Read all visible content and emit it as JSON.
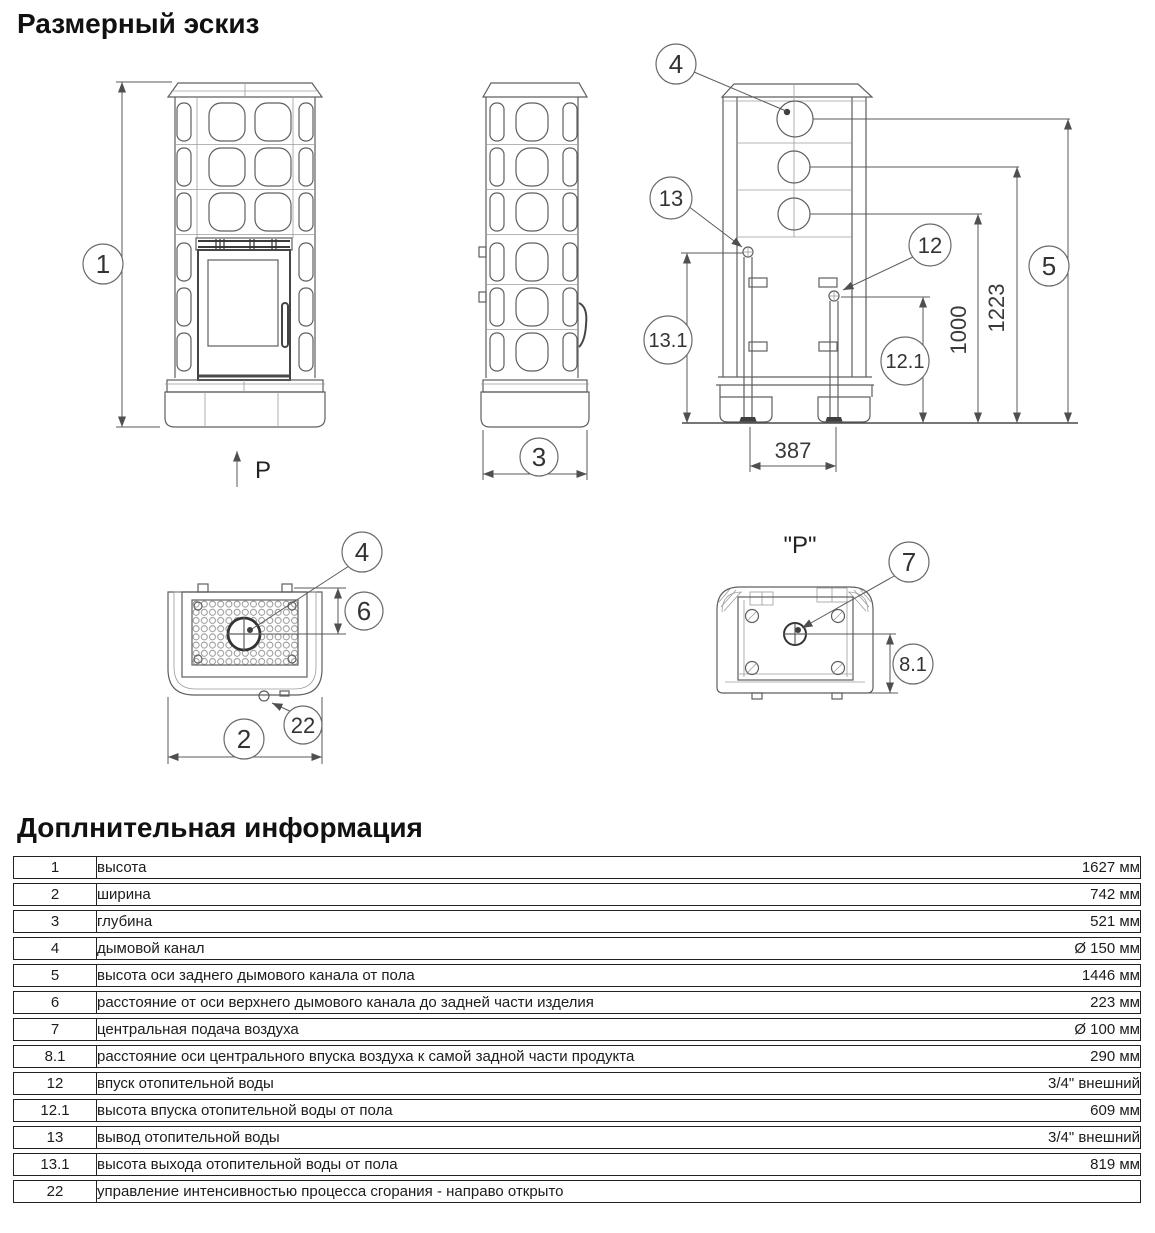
{
  "page": {
    "title": "Размерный эскиз",
    "info_title": "Доплнительная информация"
  },
  "drawing": {
    "balloons": {
      "b1": "1",
      "b2": "2",
      "b3": "3",
      "b4": "4",
      "b5": "5",
      "b6": "6",
      "b7": "7",
      "b8_1": "8.1",
      "b12": "12",
      "b12_1": "12.1",
      "b13": "13",
      "b13_1": "13.1",
      "b22": "22"
    },
    "dims": {
      "h1223": "1223",
      "h1000": "1000",
      "w387": "387"
    },
    "labels": {
      "p_arrow": "P",
      "p_view": "\"P\""
    }
  },
  "table": {
    "rows": [
      {
        "num": "1",
        "desc": "высота",
        "value": "1627 мм"
      },
      {
        "num": "2",
        "desc": "ширина",
        "value": "742 мм"
      },
      {
        "num": "3",
        "desc": "глубина",
        "value": "521 мм"
      },
      {
        "num": "4",
        "desc": "дымовой канал",
        "value": "Ø 150 мм"
      },
      {
        "num": "5",
        "desc": "высота оси заднего дымового канала от пола",
        "value": "1446 мм"
      },
      {
        "num": "6",
        "desc": "расстояние от оси верхнего дымового канала до задней части изделия",
        "value": "223 мм"
      },
      {
        "num": "7",
        "desc": "центральная подача воздуха",
        "value": "Ø 100 мм"
      },
      {
        "num": "8.1",
        "desc": "расстояние оси центрального впуска воздуха к самой задной части продукта",
        "value": "290 мм"
      },
      {
        "num": "12",
        "desc": "впуск отопительной воды",
        "value": "3/4\" внешний"
      },
      {
        "num": "12.1",
        "desc": "высота впуска отопительной воды от пола",
        "value": "609 мм"
      },
      {
        "num": "13",
        "desc": "вывод отопительной воды",
        "value": "3/4\" внешний"
      },
      {
        "num": "13.1",
        "desc": "высота выхода отопительной воды от пола",
        "value": "819 мм"
      },
      {
        "num": "22",
        "desc": "управление интенсивностью процесса сгорания - направо открыто",
        "value": ""
      }
    ]
  }
}
